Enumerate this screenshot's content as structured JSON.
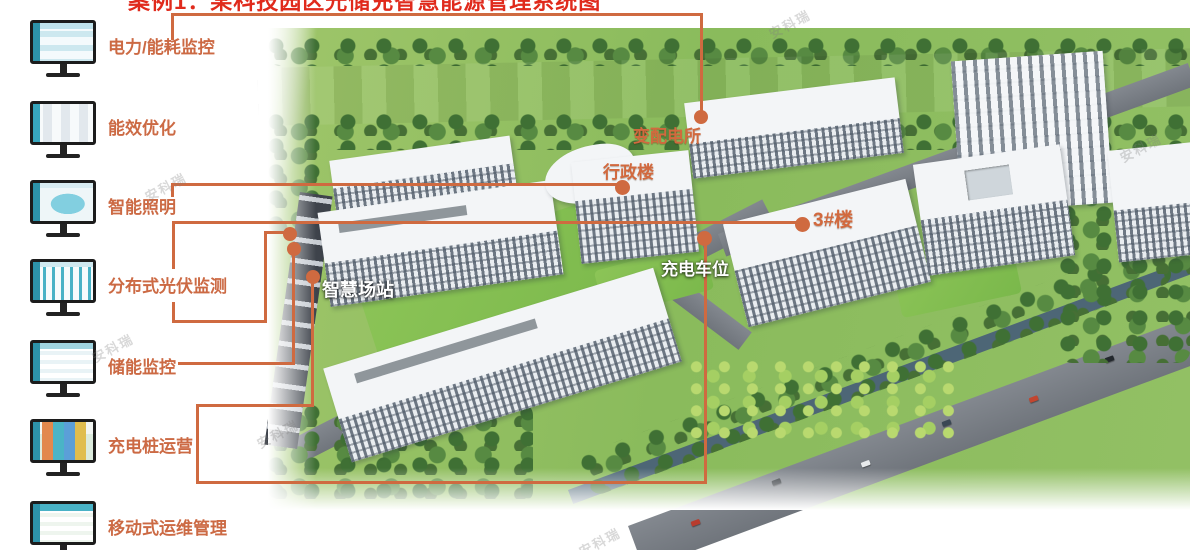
{
  "title_partial": "案例1：某科技园区光储充智慧能源管理系统图",
  "watermark_text": "安科瑞",
  "colors": {
    "accent_line": "#CF6A40",
    "sidebar_label": "#CC6A44",
    "title_red": "#E02A1C",
    "map_label_orange": "#D2693E",
    "map_label_white": "#FFFFFF"
  },
  "sidebar": {
    "items": [
      {
        "label": "电力/能耗监控",
        "icon": "monitor-energy-dashboard"
      },
      {
        "label": "能效优化",
        "icon": "monitor-efficiency"
      },
      {
        "label": "智能照明",
        "icon": "monitor-lighting-map"
      },
      {
        "label": "分布式光伏监测",
        "icon": "monitor-pv-charts"
      },
      {
        "label": "储能监控",
        "icon": "monitor-storage-table"
      },
      {
        "label": "充电桩运营",
        "icon": "monitor-charging-tiles"
      },
      {
        "label": "移动式运维管理",
        "icon": "monitor-ops-table"
      }
    ]
  },
  "map_labels": {
    "substation": "变配电所",
    "admin_building": "行政楼",
    "building_3": "3#楼",
    "charging_parking": "充电车位",
    "smart_station": "智慧场站"
  }
}
